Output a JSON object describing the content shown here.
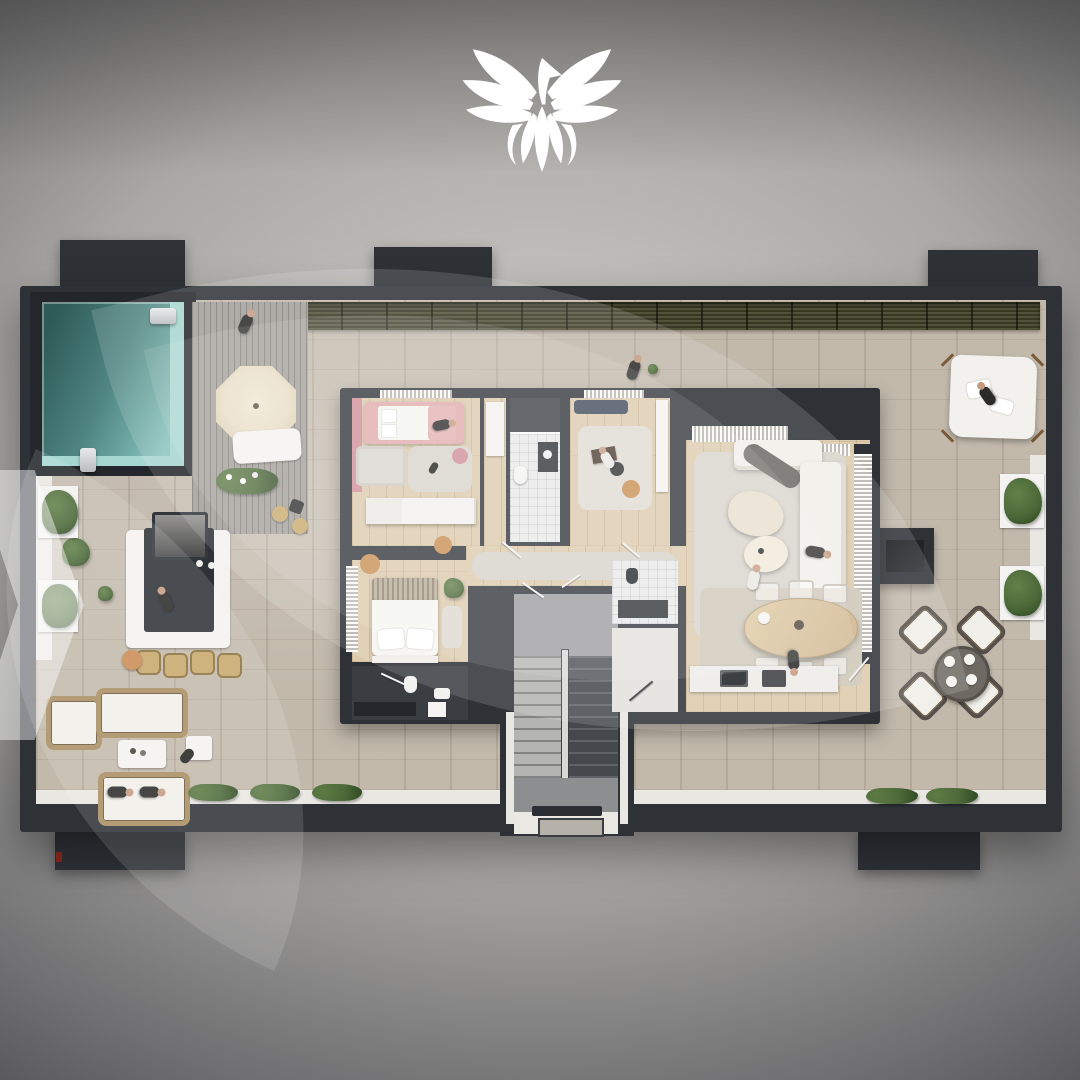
{
  "meta": {
    "description": "Top-down 3D architectural rendering of a penthouse floor plan with wrap-around terrace, swimming pool, pool deck, outdoor bar, lounge furniture, interior rooms and staircase",
    "logo_icon": "eagle-wings-spread-icon",
    "visible_text": ""
  },
  "colors": {
    "bg_center": "#d0cfcc",
    "bg_mid": "#a9a8a5",
    "bg_edge": "#57565a",
    "wall": "#2e3237",
    "wall_deep": "#23262a",
    "terrace": "#c2b9ab",
    "wood": "#dccaac",
    "deck": "#a29e98",
    "pool_deep": "#2e5a57",
    "pool_mid": "#4f8581",
    "pool_pale": "#a7d7d1",
    "hedge": "#45472e",
    "ledge": "#e9e7e2",
    "bush": "#4c6a39",
    "bush_deep": "#2f4a22",
    "rug": "#d8d4cb",
    "sofa": "#f1efe9",
    "wicker": "#a98f62",
    "wicker_deep": "#6b5a3c",
    "pink": "#e2abac",
    "pink_deep": "#d08e98",
    "navy": "#3d4759",
    "cream": "#e8ddc4",
    "table_wood": "#d6bf99",
    "stair_light": "#b4b4b2",
    "stair_dark": "#45494e",
    "stair_floor": "#9c9da0",
    "tile": "#eaeaea",
    "dark_floor": "#3a3e43",
    "white": "#f4f3f1",
    "tan": "#c98d52",
    "stool": "#c8a86b",
    "skin": "#c59b82",
    "figure": "#2b2b29",
    "red": "#8e2a20",
    "logo": "#ffffff",
    "watermark": "rgba(255,255,255,0.14)"
  }
}
